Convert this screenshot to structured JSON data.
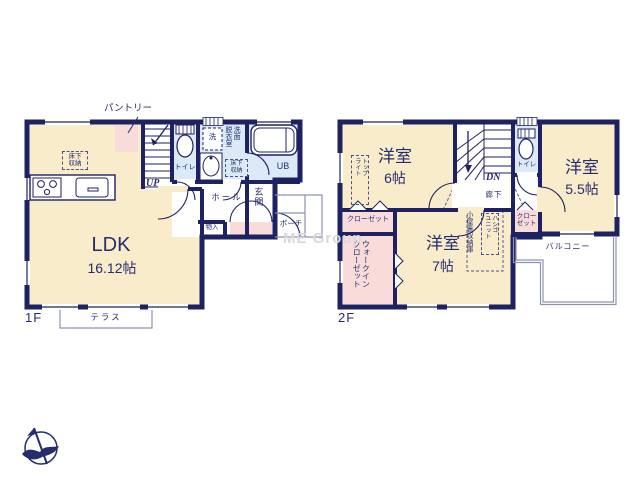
{
  "watermark": "ME Group",
  "floor1": {
    "floor_label": "1F",
    "ldk": {
      "name": "LDK",
      "size": "16.12帖"
    },
    "pantry_label": "パントリー",
    "underfloor_ldk": "床下\n収納",
    "underfloor_wash": "床下\n収納",
    "toilet": "トイレ",
    "washer": "洗",
    "washroom": "洗面\n脱衣室",
    "unit_bath": "UB",
    "hall": "ホール",
    "entrance": "玄関",
    "storage": "物入",
    "porch": "ポーチ",
    "terrace": "テラス",
    "stairs": "UP"
  },
  "floor2": {
    "floor_label": "2F",
    "room6": {
      "name": "洋室",
      "size": "6帖"
    },
    "room55": {
      "name": "洋室",
      "size": "5.5帖"
    },
    "room7": {
      "name": "洋室",
      "size": "7帖"
    },
    "skylight": "トップ\nライト",
    "toilet": "トイレ",
    "stairs": "DN",
    "corridor": "廊下",
    "closet_left": "クローゼット",
    "walk_in_closet": "ウォークイン\nクローゼット",
    "attic_storage": "小屋裏収納庫",
    "ladder_unit": "ハシゴ\nユニット",
    "closet_right": "クロー\nゼット",
    "balcony": "バルコニー"
  }
}
